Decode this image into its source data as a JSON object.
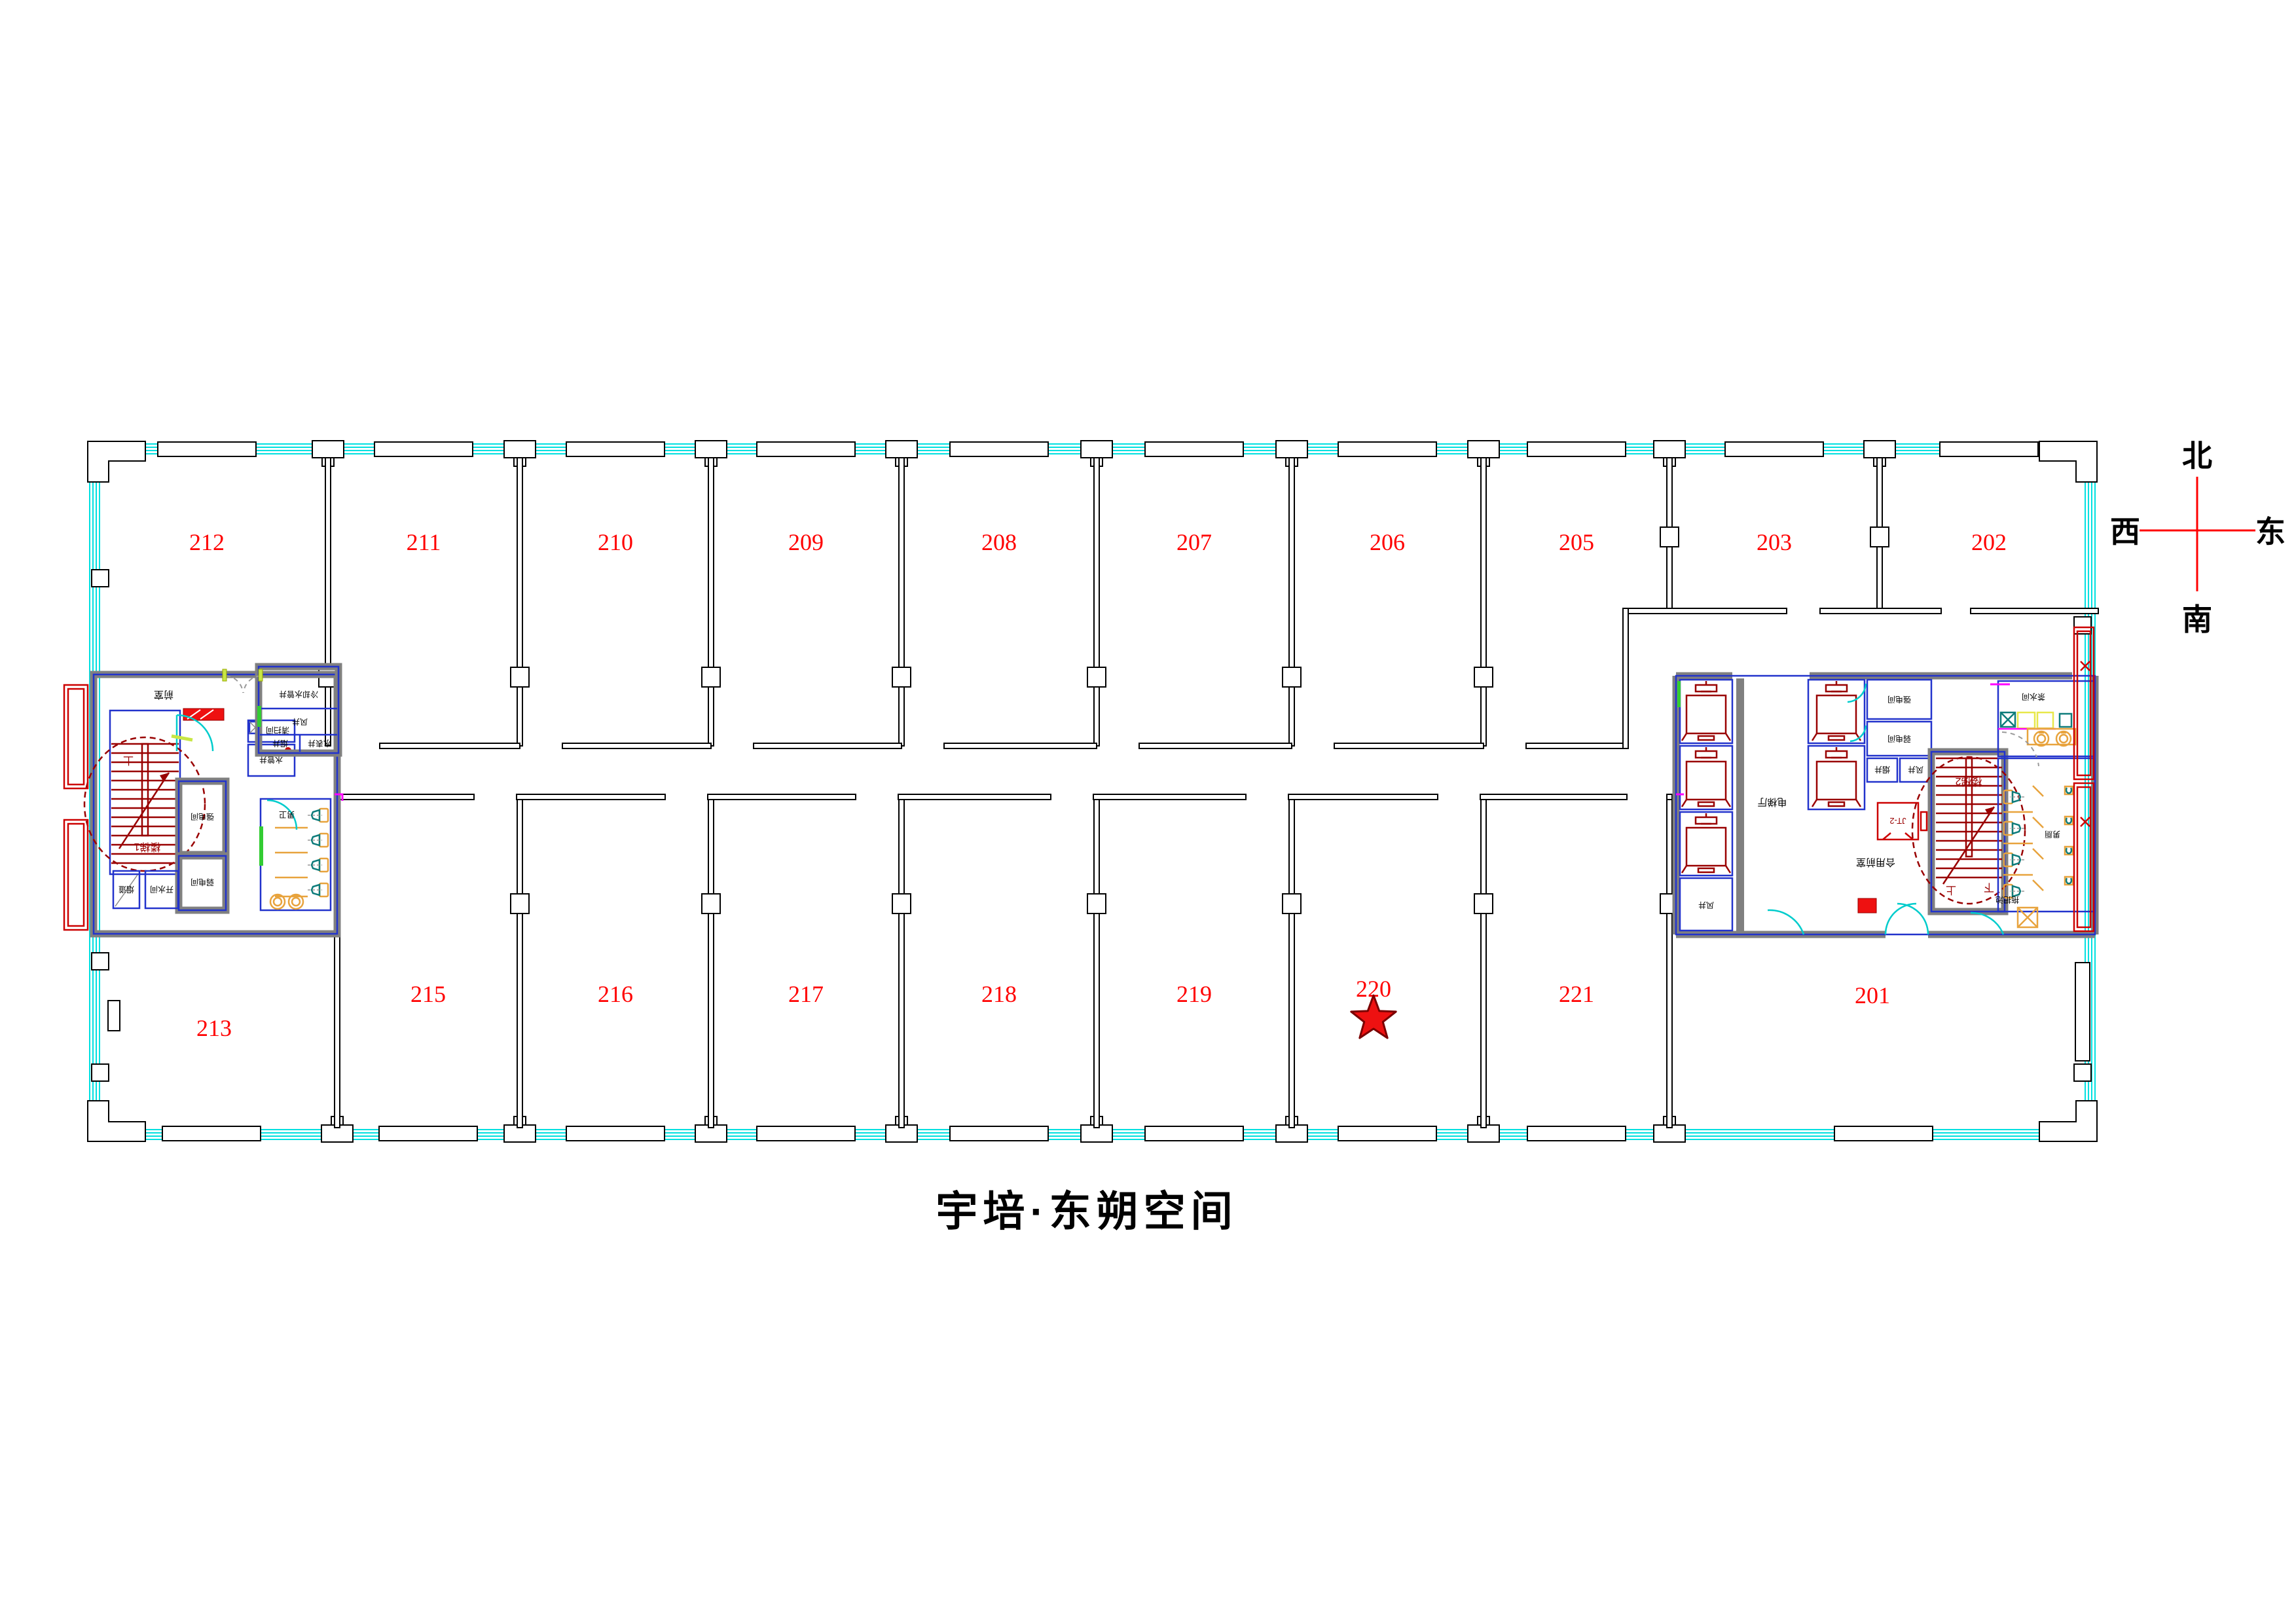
{
  "title": "宇培·东朔空间",
  "compass": {
    "north": "北",
    "south": "南",
    "west": "西",
    "east": "东"
  },
  "room_numbers": [
    "212",
    "211",
    "210",
    "209",
    "208",
    "207",
    "206",
    "205",
    "203",
    "202",
    "213",
    "215",
    "216",
    "217",
    "218",
    "219",
    "220",
    "221",
    "201"
  ],
  "marker": {
    "shape": "star",
    "located_in_room": "220",
    "color": "#ee1111"
  },
  "core_labels": {
    "left": {
      "anteroom": "前室",
      "cleaning_room": "清扫间",
      "water_pipe_shaft": "水管井",
      "cooling_water_pipe_shaft": "冷却水管井",
      "air_shaft": "风井",
      "smoke_shaft": "烟井",
      "water_meter_shaft": "水表井",
      "stair": "楼梯1",
      "up": "上",
      "strong_electric_room": "强电间",
      "weak_electric_room": "弱电间",
      "smoke_duct": "烟道",
      "hot_water_room": "开水间",
      "mens_wc": "男卫"
    },
    "right": {
      "lift_lobby": "电梯厅",
      "strong_electric_room": "强电间",
      "weak_electric_room": "弱电间",
      "smoke_shaft": "烟井",
      "air_shaft": "风井",
      "lift_code": "JT-2",
      "shared_anteroom": "合用前室",
      "stair": "楼梯2",
      "up": "上",
      "down": "下",
      "tea_room": "茶水间",
      "mens_toilet": "男厕",
      "mop_pool": "拖把池"
    }
  },
  "colors": {
    "glazing_cyan": "#00e0e0",
    "room_number_red": "#ff0000",
    "stair_dark_red": "#990000",
    "core_wall_gray": "#808080",
    "core_wall_blue": "#2233cc",
    "fixture_orange": "#e8a33d",
    "fixture_teal": "#0e7c7b",
    "door_cyan": "#00cccc",
    "door_leaf_chartreuse": "#c8e645",
    "accent_green": "#33cc33",
    "accent_magenta": "#ff00ff",
    "hydrant_red": "#ee1111"
  }
}
